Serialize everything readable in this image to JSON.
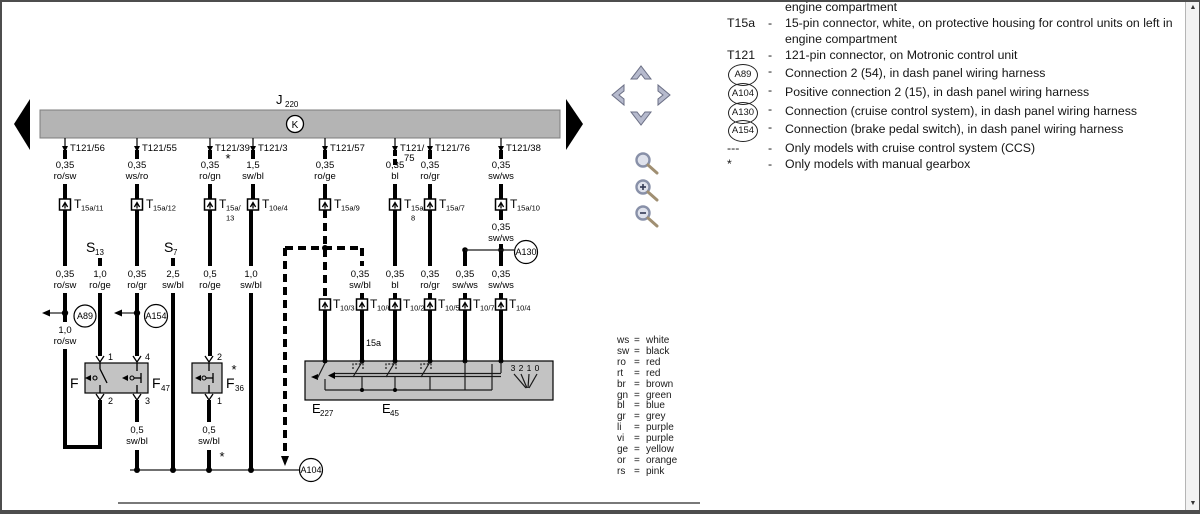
{
  "diagram": {
    "title": {
      "main": "J",
      "sub": "220"
    },
    "bus_symbol": "K",
    "columns": [
      {
        "pin": "T121/56",
        "gauge": "0,35",
        "color": "ro/sw",
        "conn": "T",
        "conn_sub": "15a/11"
      },
      {
        "pin": "T121/55",
        "gauge": "0,35",
        "color": "ws/ro",
        "conn": "T",
        "conn_sub": "15a/12"
      },
      {
        "pin": "T121/39",
        "note": "*",
        "gauge": "0,35",
        "color": "ro/gn",
        "conn": "T",
        "conn_sub": "15a/",
        "conn_sub2": "13"
      },
      {
        "pin": "T121/3",
        "gauge": "1,5",
        "color": "sw/bl",
        "conn": "T",
        "conn_sub": "10e/4"
      },
      {
        "pin": "T121/57",
        "gauge": "0,35",
        "color": "ro/ge",
        "conn": "T",
        "conn_sub": "15a/9"
      },
      {
        "pin": "T121/",
        "pin2": "75",
        "gauge": "0,35",
        "color": "bl",
        "conn": "T",
        "conn_sub": "15a/",
        "conn_sub2": "8"
      },
      {
        "pin": "T121/76",
        "gauge": "0,35",
        "color": "ro/gr",
        "conn": "T",
        "conn_sub": "15a/7"
      },
      {
        "pin": "T121/38",
        "gauge": "0,35",
        "color": "sw/ws",
        "conn": "T",
        "conn_sub": "15a/10"
      }
    ],
    "switches": [
      {
        "main": "S",
        "sub": "13"
      },
      {
        "main": "S",
        "sub": "7"
      }
    ],
    "mid_labels": [
      {
        "gauge": "0,35",
        "color": "ro/sw"
      },
      {
        "gauge": "1,0",
        "color": "ro/ge"
      },
      {
        "gauge": "0,35",
        "color": "ro/gr"
      },
      {
        "gauge": "2,5",
        "color": "sw/bl"
      },
      {
        "gauge": "0,5",
        "color": "ro/ge"
      },
      {
        "gauge": "1,0",
        "color": "sw/bl"
      }
    ],
    "c1_lower_label": {
      "gauge": "1,0",
      "color": "ro/sw"
    },
    "c8_mid_label": {
      "gauge": "0,35",
      "color": "sw/ws"
    },
    "connections": {
      "a89": "A89",
      "a154": "A154",
      "a130": "A130",
      "a104": "A104"
    },
    "fuse_row": {
      "f": {
        "main": "F"
      },
      "f47": {
        "main": "F",
        "sub": "47"
      },
      "f36": {
        "main": "F",
        "sub": "36"
      },
      "note": "*",
      "pins": {
        "f_top": "1",
        "f_bottom": "2",
        "f47_top": "4",
        "f47_bottom": "3",
        "f36_top": "2",
        "f36_bottom": "1"
      }
    },
    "lower_labels": [
      {
        "gauge": "0,5",
        "color": "sw/bl"
      },
      {
        "gauge": "0,5",
        "color": "sw/bl",
        "note": "*"
      }
    ],
    "terminal_15a": "15a",
    "bottom_row": {
      "labels": [
        {
          "gauge": "0,35",
          "color": "sw/bl"
        },
        {
          "gauge": "0,35",
          "color": "bl"
        },
        {
          "gauge": "0,35",
          "color": "ro/gr"
        },
        {
          "gauge": "0,35",
          "color": "sw/ws"
        },
        {
          "gauge": "0,35",
          "color": "sw/ws"
        }
      ],
      "connectors": [
        {
          "conn": "T",
          "sub": "10/3"
        },
        {
          "conn": "T",
          "sub": "10/6"
        },
        {
          "conn": "T",
          "sub": "10/2"
        },
        {
          "conn": "T",
          "sub": "10/5"
        },
        {
          "conn": "T",
          "sub": "10/7"
        },
        {
          "conn": "T",
          "sub": "10/4"
        }
      ]
    },
    "components": [
      {
        "main": "E",
        "sub": "227"
      },
      {
        "main": "E",
        "sub": "45"
      }
    ],
    "selector_positions": [
      "3",
      "2",
      "1",
      "0"
    ]
  },
  "color_legend": {
    "eq": "=",
    "rows": [
      {
        "abbr": "ws",
        "name": "white"
      },
      {
        "abbr": "sw",
        "name": "black"
      },
      {
        "abbr": "ro",
        "name": "red"
      },
      {
        "abbr": "rt",
        "name": "red"
      },
      {
        "abbr": "br",
        "name": "brown"
      },
      {
        "abbr": "gn",
        "name": "green"
      },
      {
        "abbr": "bl",
        "name": "blue"
      },
      {
        "abbr": "gr",
        "name": "grey"
      },
      {
        "abbr": "li",
        "name": "purple"
      },
      {
        "abbr": "vi",
        "name": "purple"
      },
      {
        "abbr": "ge",
        "name": "yellow"
      },
      {
        "abbr": "or",
        "name": "orange"
      },
      {
        "abbr": "rs",
        "name": "pink"
      }
    ]
  },
  "right_panel": {
    "dash": "-",
    "rows": [
      {
        "text": "engine compartment"
      },
      {
        "label": "T15a",
        "text": "15-pin connector, white, on protective housing for control units on left in",
        "text2": "engine compartment"
      },
      {
        "label": "T121",
        "text": "121-pin connector, on Motronic control unit"
      },
      {
        "circle": "A89",
        "text": "Connection 2 (54), in dash panel wiring harness"
      },
      {
        "circle": "A104",
        "text": "Positive connection 2 (15), in dash panel wiring harness"
      },
      {
        "circle": "A130",
        "text": "Connection (cruise control system), in dash panel wiring harness"
      },
      {
        "circle": "A154",
        "text": "Connection (brake pedal switch), in dash panel wiring harness"
      },
      {
        "label": "---",
        "text": "Only models with cruise control system (CCS)"
      },
      {
        "label": "*",
        "text": "Only models with manual gearbox"
      }
    ]
  },
  "nav": {
    "pan_icons": [
      "chevron-up",
      "chevron-left",
      "chevron-right",
      "chevron-down"
    ],
    "zoom_icons": [
      "magnifier",
      "magnifier-plus",
      "magnifier-minus"
    ],
    "page_icons": [
      "page-prev-arrow",
      "page-next-arrow"
    ]
  },
  "scrollbar_icons": {
    "up": "▲",
    "down": "▼"
  },
  "colors": {
    "bus_fill": "#b4b4b4",
    "component_fill": "#c3c3c3",
    "wire": "#000000",
    "frame": "#4d4d4d",
    "nav_icon": "#b6bacd"
  }
}
